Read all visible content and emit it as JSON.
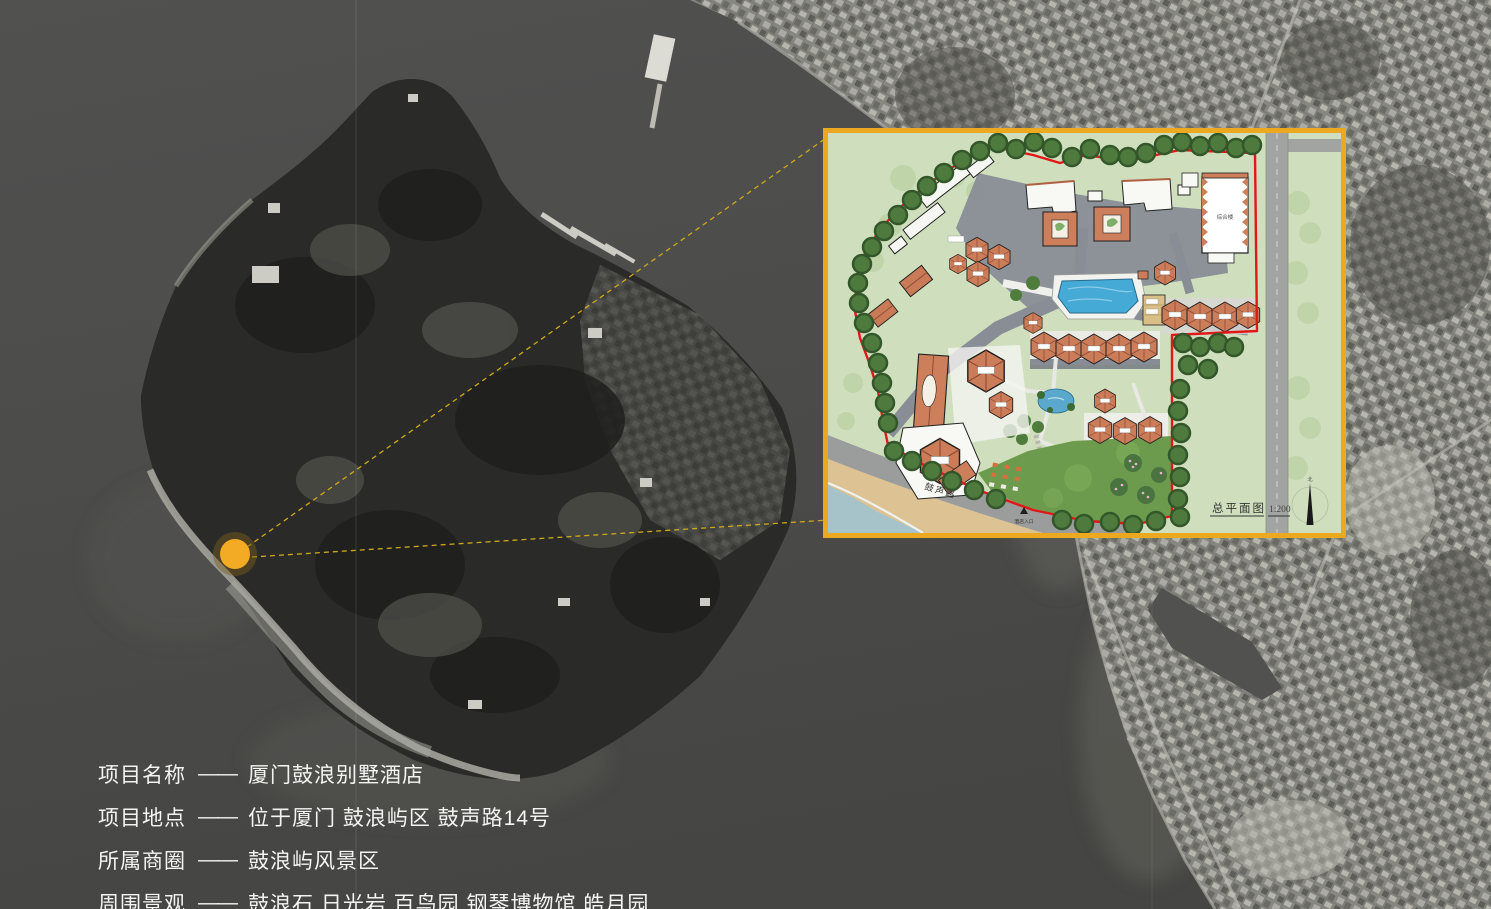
{
  "info_panel": {
    "rows": [
      {
        "label": "项目名称",
        "dash": "——",
        "value": "厦门鼓浪别墅酒店"
      },
      {
        "label": "项目地点",
        "dash": "——",
        "value": "位于厦门 鼓浪屿区 鼓声路14号"
      },
      {
        "label": "所属商圈",
        "dash": "——",
        "value": "鼓浪屿风景区"
      },
      {
        "label": "周围景观",
        "dash": "——",
        "value": "鼓浪石 日光岩 百鸟园 钢琴博物馆 皓月园"
      }
    ]
  },
  "inset": {
    "plan_title": "总平面图",
    "plan_scale": "1:200",
    "road_label": "鼓声路",
    "entrance_label": "酒店入口",
    "north_label": "北",
    "main_building_label": "综合楼"
  },
  "colors": {
    "accent_border": "#eca81e",
    "marker_fill": "#f3ab25",
    "marker_ring": "rgba(125,95,28,0.45)",
    "callout_line": "#cfa81a",
    "boundary_red": "#e01818",
    "water_gray": "#414140"
  }
}
